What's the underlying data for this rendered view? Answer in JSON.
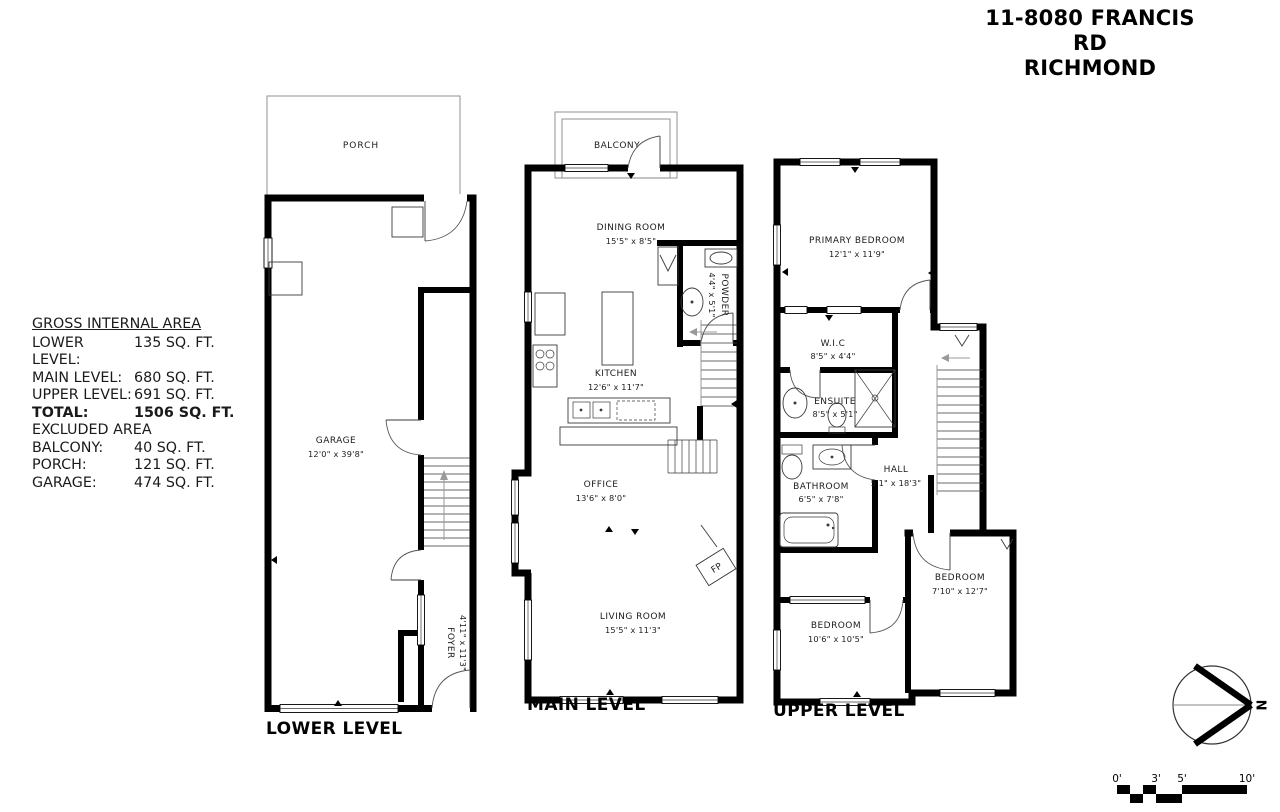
{
  "colors": {
    "wall": "#000000",
    "thin_line": "#3a3a3a",
    "light_line": "#9a9a9a",
    "background": "#ffffff"
  },
  "header": {
    "title_line1": "11-8080 FRANCIS RD",
    "title_line2": "RICHMOND"
  },
  "area_summary": {
    "heading": "GROSS INTERNAL AREA",
    "rows": [
      {
        "label": "LOWER LEVEL:",
        "value": "135 SQ. FT."
      },
      {
        "label": "MAIN LEVEL:",
        "value": "680 SQ. FT."
      },
      {
        "label": "UPPER LEVEL:",
        "value": "691 SQ. FT."
      },
      {
        "label": "TOTAL:",
        "value": "1506 SQ. FT."
      }
    ],
    "excluded_heading": "EXCLUDED AREA",
    "excluded_rows": [
      {
        "label": "BALCONY:",
        "value": "40 SQ. FT."
      },
      {
        "label": "PORCH:",
        "value": "121 SQ. FT."
      },
      {
        "label": "GARAGE:",
        "value": "474 SQ. FT."
      }
    ]
  },
  "levels": {
    "lower": {
      "label": "LOWER LEVEL",
      "rooms": {
        "porch": {
          "name": "PORCH"
        },
        "garage": {
          "name": "GARAGE",
          "dims": "12'0\" x 39'8\""
        },
        "foyer": {
          "name": "FOYER",
          "dims": "4'11\" x 11'3\""
        }
      }
    },
    "main": {
      "label": "MAIN LEVEL",
      "rooms": {
        "balcony": {
          "name": "BALCONY"
        },
        "dining": {
          "name": "DINING ROOM",
          "dims": "15'5\" x 8'5\""
        },
        "powder": {
          "name": "POWDER",
          "dims": "4'4\" x 5'1\""
        },
        "kitchen": {
          "name": "KITCHEN",
          "dims": "12'6\" x 11'7\""
        },
        "office": {
          "name": "OFFICE",
          "dims": "13'6\" x 8'0\""
        },
        "living": {
          "name": "LIVING ROOM",
          "dims": "15'5\" x 11'3\""
        },
        "fireplace": {
          "name": "FP"
        }
      }
    },
    "upper": {
      "label": "UPPER LEVEL",
      "rooms": {
        "primary": {
          "name": "PRIMARY BEDROOM",
          "dims": "12'1\" x 11'9\""
        },
        "wic": {
          "name": "W.I.C",
          "dims": "8'5\" x 4'4\""
        },
        "ensuite": {
          "name": "ENSUITE",
          "dims": "8'5\" x 5'1\""
        },
        "bathroom": {
          "name": "BATHROOM",
          "dims": "6'5\" x 7'8\""
        },
        "hall": {
          "name": "HALL",
          "dims": "5'1\" x 18'3\""
        },
        "bedroom_left": {
          "name": "BEDROOM",
          "dims": "10'6\" x 10'5\""
        },
        "bedroom_right": {
          "name": "BEDROOM",
          "dims": "7'10\" x 12'7\""
        }
      }
    }
  },
  "compass": {
    "north_label": "N"
  },
  "scale_bar": {
    "ticks": [
      "0'",
      "3'",
      "5'",
      "10'"
    ]
  }
}
